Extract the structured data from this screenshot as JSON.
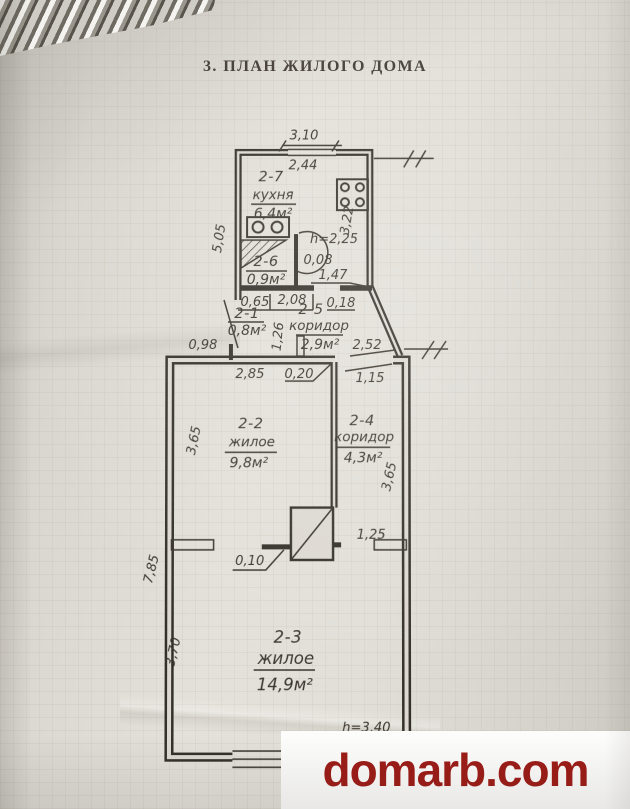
{
  "title": "3. ПЛАН ЖИЛОГО ДОМА",
  "watermark": {
    "text": "domarb.com",
    "color": "#9c1b16"
  },
  "plan": {
    "rooms": [
      {
        "id": "2-7",
        "name": "кухня",
        "area": "6,4м²",
        "height": "h=2,25"
      },
      {
        "id": "2-6",
        "name": "",
        "area": "0,9м²"
      },
      {
        "id": "2-1",
        "name": "",
        "area": "0,8м²"
      },
      {
        "id": "2-5",
        "name": "коридор",
        "area": "2,9м²"
      },
      {
        "id": "2-2",
        "name": "жилое",
        "area": "9,8м²"
      },
      {
        "id": "2-4",
        "name": "коридор",
        "area": "4,3м²"
      },
      {
        "id": "2-3",
        "name": "жилое",
        "area": "14,9м²",
        "height": "h=3,40"
      }
    ],
    "dims": {
      "top_width": "3,10",
      "kitchen_inner_width": "2,44",
      "kitchen_left_height": "5,05",
      "kitchen_right_height": "3,22",
      "wall_008": "0,08",
      "door_147": "1,47",
      "seg_065": "0,65",
      "seg_208": "2,08",
      "seg_018": "0,18",
      "corridor_126": "1,26",
      "ext_098": "0,98",
      "diag_252": "2,52",
      "room22_width": "2,85",
      "wall_020": "0,20",
      "door_115": "1,15",
      "room22_height": "3,65",
      "room24_height": "3,65",
      "stub_125": "1,25",
      "stub_010": "0,10",
      "left_total": "7,85",
      "room23_height": "3,70"
    }
  }
}
